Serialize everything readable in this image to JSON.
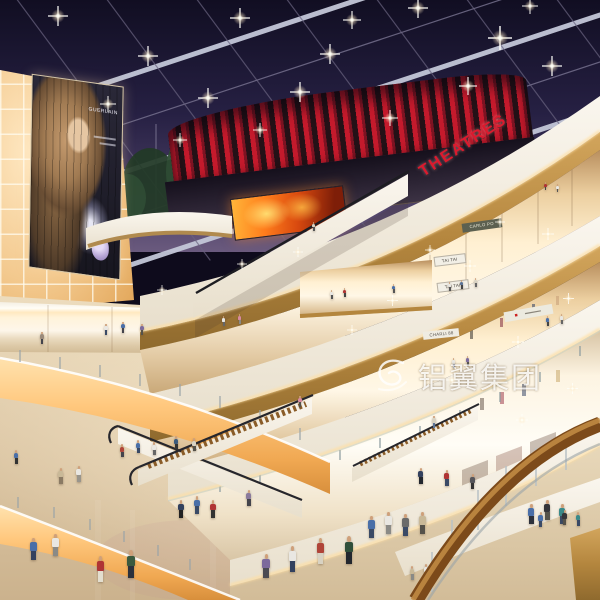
{
  "scene": {
    "type": "architectural rendering",
    "setting": "multi-level shopping mall atrium at night with glass grid skylight, curved balconies, escalators and glowing storefronts",
    "watermark": {
      "text": "铝翼集团"
    },
    "signs": {
      "theatre": "THEATRES",
      "billboard_brand": "GUERLAIN",
      "shop_level4": "CARLO PO",
      "shop_tai_upper": "TAI TAI",
      "shop_tai_lower": "TAI TAI",
      "shop_level3": "CHARLI 88"
    },
    "palette": {
      "night_sky": "#262043",
      "skylight_beam": "#c3c7d8",
      "theatre_red": "#c41a2c",
      "led_fire_orange": "#ff7d1c",
      "wood_parapet": "#b4863e",
      "handrail_wood": "#7c4a1a",
      "fascia_white": "#f8f3e9",
      "glow_amber": "#ffc87e",
      "wall_glow": "#f3c98e",
      "floor_beige": "#dcc6a4"
    },
    "lights": [
      [
        58,
        16,
        1
      ],
      [
        148,
        56,
        1
      ],
      [
        240,
        18,
        1
      ],
      [
        330,
        54,
        1
      ],
      [
        418,
        8,
        1
      ],
      [
        300,
        92,
        1
      ],
      [
        500,
        38,
        1.2
      ],
      [
        552,
        66,
        1
      ],
      [
        208,
        98,
        1
      ],
      [
        390,
        118,
        0.8
      ],
      [
        468,
        86,
        0.9
      ],
      [
        108,
        104,
        0.8
      ],
      [
        352,
        20,
        0.9
      ],
      [
        530,
        6,
        0.8
      ],
      [
        260,
        130,
        0.7
      ],
      [
        180,
        140,
        0.7
      ],
      [
        470,
        266,
        0.6
      ],
      [
        548,
        234,
        0.6
      ],
      [
        392,
        300,
        0.55
      ],
      [
        518,
        342,
        0.6
      ],
      [
        568,
        298,
        0.55
      ],
      [
        452,
        380,
        0.6
      ],
      [
        352,
        330,
        0.5
      ],
      [
        298,
        252,
        0.5
      ],
      [
        242,
        264,
        0.5
      ],
      [
        162,
        290,
        0.5
      ],
      [
        522,
        420,
        0.6
      ],
      [
        572,
        388,
        0.55
      ],
      [
        430,
        250,
        0.5
      ],
      [
        500,
        222,
        0.5
      ]
    ],
    "figures": [
      [
        96,
        556,
        26,
        "#b03434",
        "#e3decf"
      ],
      [
        126,
        550,
        28,
        "#3c5a3e",
        "#2c313c"
      ],
      [
        262,
        554,
        24,
        "#7c6a9c",
        "#4a4a52"
      ],
      [
        288,
        546,
        26,
        "#e9e7e2",
        "#33415e"
      ],
      [
        316,
        538,
        26,
        "#b04438",
        "#d8d2c2"
      ],
      [
        344,
        536,
        28,
        "#2f4f3a",
        "#23272e"
      ],
      [
        368,
        516,
        22,
        "#4a6fa8",
        "#3a4a66"
      ],
      [
        385,
        512,
        22,
        "#e9e7e2",
        "#8a8a86"
      ],
      [
        402,
        514,
        22,
        "#6a6a6a",
        "#3a4a66"
      ],
      [
        419,
        512,
        22,
        "#c9b998",
        "#55524a"
      ],
      [
        528,
        504,
        20,
        "#4a6fa8",
        "#2c313c"
      ],
      [
        544,
        500,
        20,
        "#35353a",
        "#55524a"
      ],
      [
        559,
        504,
        20,
        "#3a8a8a",
        "#3a4a66"
      ],
      [
        178,
        500,
        18,
        "#33415e",
        "#222222"
      ],
      [
        194,
        496,
        18,
        "#4a6fa8",
        "#3a4a66"
      ],
      [
        210,
        500,
        18,
        "#b03434",
        "#333333"
      ],
      [
        246,
        490,
        16,
        "#8a7a9c",
        "#44444c"
      ],
      [
        30,
        538,
        22,
        "#4a6fa8",
        "#33415e"
      ],
      [
        52,
        534,
        22,
        "#e9e7e2",
        "#8a8a86"
      ],
      [
        58,
        468,
        16,
        "#c9b998",
        "#8a7a64"
      ],
      [
        76,
        466,
        16,
        "#e9e7e2",
        "#99958c"
      ],
      [
        120,
        444,
        13,
        "#b04438",
        "#44444c"
      ],
      [
        136,
        440,
        13,
        "#4a6fa8",
        "#3a4a66"
      ],
      [
        152,
        442,
        13,
        "#e9e7e2",
        "#666666"
      ],
      [
        174,
        436,
        13,
        "#3a5a7c",
        "#333333"
      ],
      [
        192,
        438,
        13,
        "#d8d2c2",
        "#55524a"
      ],
      [
        14,
        450,
        14,
        "#4a6fa8",
        "#333333"
      ],
      [
        40,
        332,
        12,
        "#9a8a7a",
        "#44444c"
      ],
      [
        104,
        324,
        11,
        "#e9e7e2",
        "#3a4a66"
      ],
      [
        121,
        322,
        11,
        "#4a6fa8",
        "#44444c"
      ],
      [
        140,
        324,
        11,
        "#7c6a9c",
        "#55524a"
      ],
      [
        222,
        316,
        10,
        "#e9e7e2",
        "#666666"
      ],
      [
        238,
        314,
        10,
        "#d88aa0",
        "#8a8a86"
      ],
      [
        330,
        290,
        9,
        "#e9e7e2",
        "#555555"
      ],
      [
        343,
        288,
        9,
        "#b03434",
        "#444444"
      ],
      [
        392,
        284,
        9,
        "#4a6fa8",
        "#555555"
      ],
      [
        448,
        282,
        9,
        "#e9e7e2",
        "#555555"
      ],
      [
        460,
        280,
        9,
        "#5a7396",
        "#444444"
      ],
      [
        474,
        278,
        9,
        "#d8d2c2",
        "#666666"
      ],
      [
        544,
        182,
        8,
        "#b03434",
        "#444444"
      ],
      [
        556,
        184,
        8,
        "#e9e7e2",
        "#555555"
      ],
      [
        452,
        358,
        10,
        "#e9e7e2",
        "#3a4a66"
      ],
      [
        466,
        356,
        10,
        "#7c6a9c",
        "#555555"
      ],
      [
        546,
        316,
        10,
        "#4a6fa8",
        "#444444"
      ],
      [
        560,
        314,
        10,
        "#e9e7e2",
        "#666666"
      ],
      [
        312,
        222,
        9,
        "#d8d2c2",
        "#555555"
      ],
      [
        298,
        396,
        11,
        "#d88aa0",
        "#55524a"
      ],
      [
        432,
        416,
        12,
        "#d8d2c2",
        "#5a7396"
      ],
      [
        418,
        468,
        16,
        "#33415e",
        "#23272e"
      ],
      [
        444,
        470,
        16,
        "#b03434",
        "#3a4a66"
      ],
      [
        470,
        474,
        15,
        "#55555a",
        "#333333"
      ],
      [
        538,
        512,
        15,
        "#4a6fa8",
        "#3a4a66"
      ],
      [
        562,
        510,
        15,
        "#35353a",
        "#55524a"
      ],
      [
        576,
        512,
        14,
        "#3a8a8a",
        "#3a4a66"
      ],
      [
        410,
        566,
        14,
        "#c9b998",
        "#8a8a86"
      ],
      [
        424,
        564,
        14,
        "#e9e7e2",
        "#33415e"
      ]
    ]
  }
}
